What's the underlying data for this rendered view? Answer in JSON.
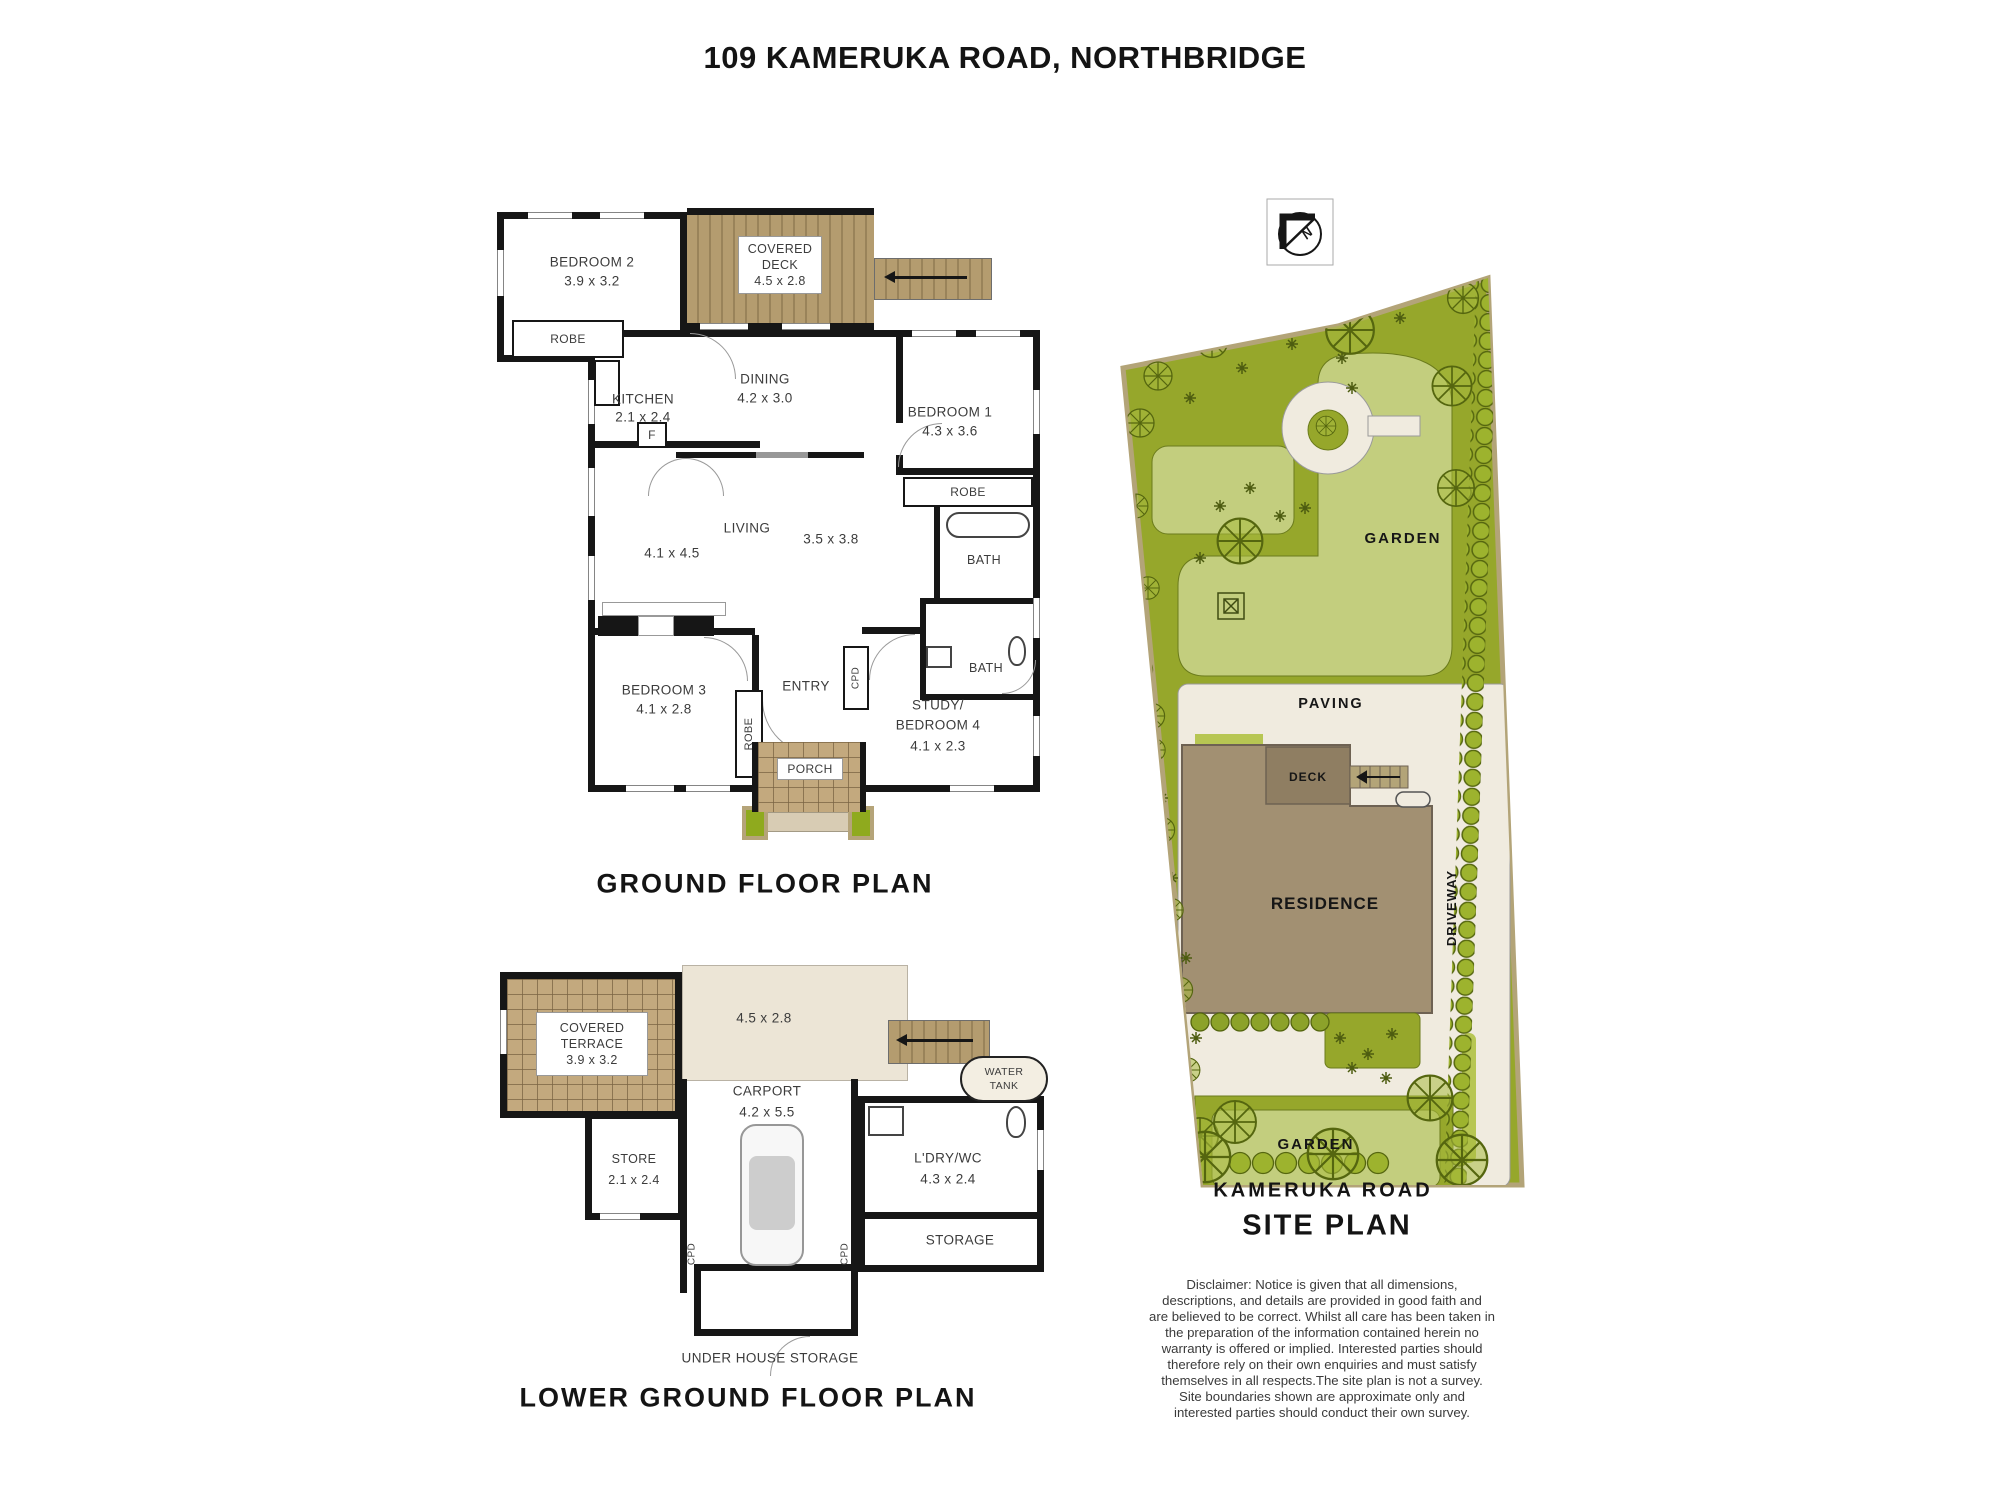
{
  "page_title": "109 KAMERUKA ROAD, NORTHBRIDGE",
  "colors": {
    "wall_black": "#161616",
    "deck_brown": "#b49c6f",
    "tile_brown": "#c3a97e",
    "site_green_dark": "#96a72b",
    "site_green_light": "#c3ce7e",
    "paving_cream": "#f0ebdf",
    "residence_brown": "#a29072",
    "hedge_green": "#9db32e"
  },
  "icons": {
    "north": "north-arrow-icon"
  },
  "gf": {
    "title": "GROUND FLOOR PLAN",
    "bedroom2": "BEDROOM 2",
    "bedroom2_d": "3.9 x 3.2",
    "deck_l1": "COVERED",
    "deck_l2": "DECK",
    "deck_d": "4.5 x 2.8",
    "robe": "ROBE",
    "kitchen": "KITCHEN",
    "kitchen_d": "2.1 x 2.4",
    "fridge": "F",
    "dining": "DINING",
    "dining_d": "4.2 x 3.0",
    "bedroom1": "BEDROOM 1",
    "bedroom1_d": "4.3 x 3.6",
    "living": "LIVING",
    "living_d1": "4.1 x 4.5",
    "living_d2": "3.5 x 3.8",
    "bath": "BATH",
    "bedroom3": "BEDROOM 3",
    "bedroom3_d": "4.1 x 2.8",
    "entry": "ENTRY",
    "cpd": "CPD",
    "study_l1": "STUDY/",
    "study_l2": "BEDROOM 4",
    "study_d": "4.1 x 2.3",
    "porch": "PORCH"
  },
  "lgf": {
    "title": "LOWER GROUND FLOOR PLAN",
    "terrace_l1": "COVERED",
    "terrace_l2": "TERRACE",
    "terrace_d": "3.9 x 3.2",
    "open_d": "4.5 x 2.8",
    "carport": "CARPORT",
    "carport_d": "4.2 x 5.5",
    "store": "STORE",
    "store_d": "2.1 x 2.4",
    "laundry": "L'DRY/WC",
    "laundry_d": "4.3 x 2.4",
    "storage": "STORAGE",
    "water_l1": "WATER",
    "water_l2": "TANK",
    "cpd": "CPD",
    "under_house": "UNDER HOUSE STORAGE"
  },
  "site": {
    "title": "SITE PLAN",
    "road": "KAMERUKA ROAD",
    "garden_top": "GARDEN",
    "garden_bottom": "GARDEN",
    "paving": "PAVING",
    "deck": "DECK",
    "residence": "RESIDENCE",
    "driveway": "DRIVEWAY",
    "north": "N"
  },
  "disclaimer": [
    "Disclaimer: Notice is given that all dimensions,",
    "descriptions, and details are provided in good faith and",
    "are believed to be correct. Whilst all care has been taken in",
    "the preparation of the information contained herein no",
    "warranty is offered or implied. Interested parties should",
    "therefore rely on their own enquiries and must satisfy",
    "themselves in all respects.The site plan is not a survey.",
    "Site boundaries shown are approximate only and",
    "interested parties should conduct their own survey."
  ]
}
